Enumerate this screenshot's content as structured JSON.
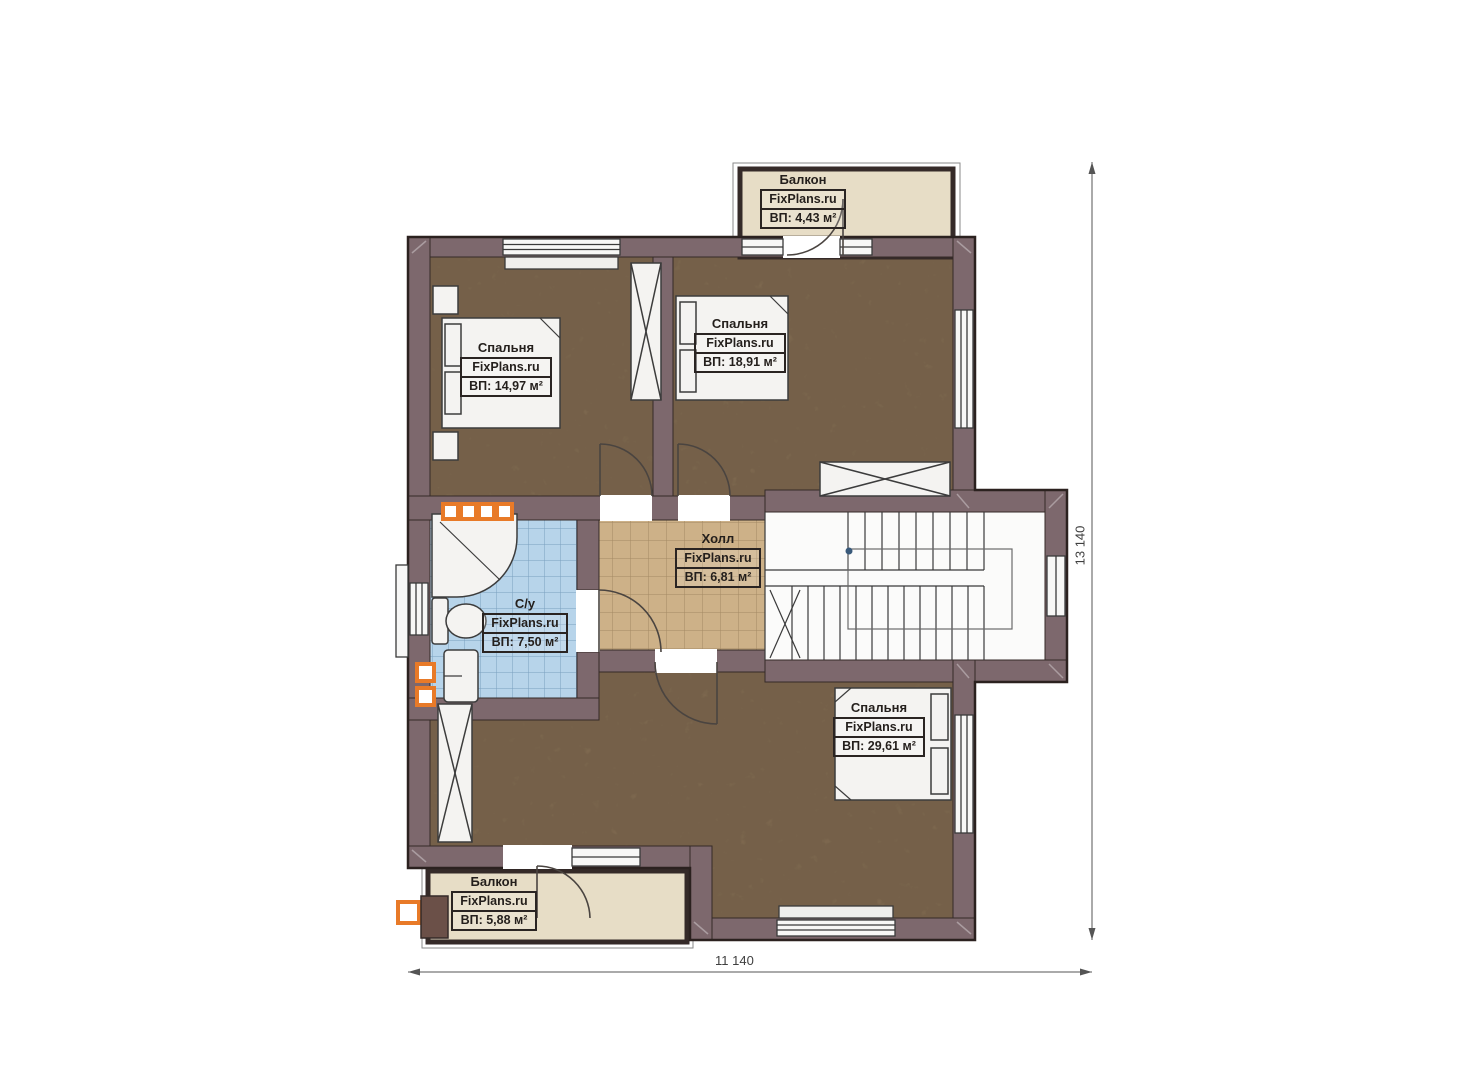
{
  "plan": {
    "brand": "FixPlans.ru",
    "rooms": [
      {
        "id": "bedroom-top-left",
        "name": "Спальня",
        "area": "ВП: 14,97 м²"
      },
      {
        "id": "bedroom-top-middle",
        "name": "Спальня",
        "area": "ВП: 18,91 м²"
      },
      {
        "id": "hall",
        "name": "Холл",
        "area": "ВП: 6,81 м²"
      },
      {
        "id": "bathroom",
        "name": "С/у",
        "area": "ВП: 7,50 м²"
      },
      {
        "id": "bedroom-bottom",
        "name": "Спальня",
        "area": "ВП: 29,61 м²"
      },
      {
        "id": "balcony-top",
        "name": "Балкон",
        "area": "ВП: 4,43 м²"
      },
      {
        "id": "balcony-bottom",
        "name": "Балкон",
        "area": "ВП: 5,88 м²"
      }
    ],
    "dimensions": {
      "width_label": "11 140",
      "height_label": "13 140"
    },
    "colors": {
      "wall": "#7d686d",
      "bedroom_floor": "#8c7458",
      "hall_floor": "#cdb188",
      "bath_floor": "#b7d4ea",
      "balcony_floor": "#e7ddc6",
      "accent_orange": "#e87a28"
    }
  }
}
